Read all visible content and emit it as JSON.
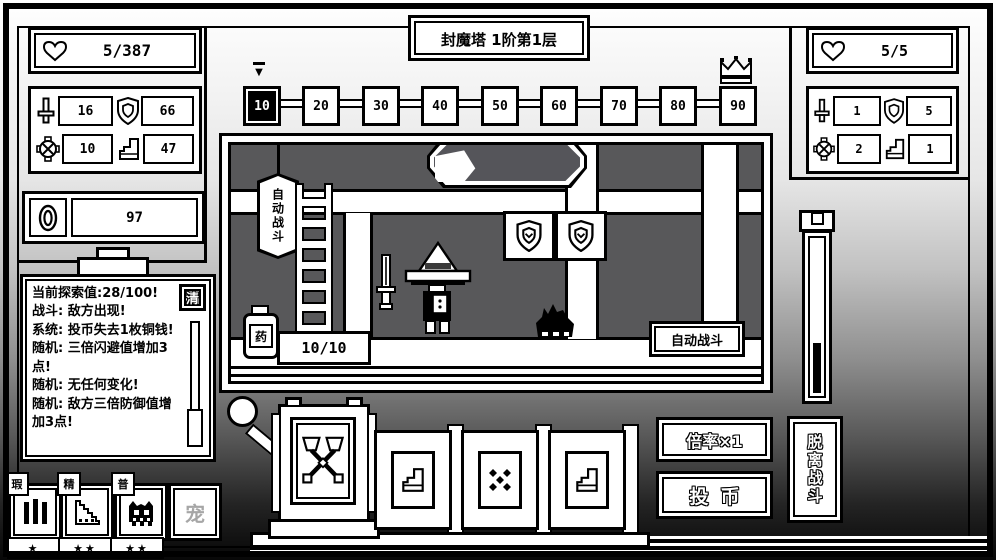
{
  "colors": {
    "background_top": "#ffffff",
    "background_bottom": "#070707",
    "room_gray": "#58585a",
    "panel_white": "#ffffff",
    "ink_black": "#000000",
    "disabled_gray": "#a6a6a6"
  },
  "header": {
    "title": "封魔塔 1阶第1层"
  },
  "player_panel": {
    "hp": "5/387",
    "atk": "16",
    "def": "66",
    "acc": "10",
    "spd": "47",
    "coins": "97"
  },
  "enemy_panel": {
    "hp": "5/5",
    "atk": "1",
    "def": "5",
    "acc": "2",
    "spd": "1"
  },
  "track": {
    "marker": "▼",
    "nodes": [
      "10",
      "20",
      "30",
      "40",
      "50",
      "60",
      "70",
      "80",
      "90"
    ],
    "current": "10"
  },
  "scene": {
    "hanging_sign": "自动战斗",
    "auto_battle_button": "自动战斗",
    "potion_label": "药",
    "potion_count": "10/10"
  },
  "log": {
    "clear": "清",
    "lines": [
      "当前探索值:28/100!",
      "战斗: 敌方出现!",
      "系统: 投币失去1枚铜钱!",
      "随机: 三倍闪避值增加3点!",
      "随机: 无任何变化!",
      "随机: 敌方三倍防御值增加3点!"
    ]
  },
  "units": {
    "badges": [
      "瑕",
      "精",
      "普"
    ],
    "pet": "宠",
    "stars": [
      "★",
      "★★",
      "★★"
    ]
  },
  "controls": {
    "multiplier": "倍率×1",
    "insert_coin": "投币",
    "leave_battle": "脱离战斗"
  }
}
